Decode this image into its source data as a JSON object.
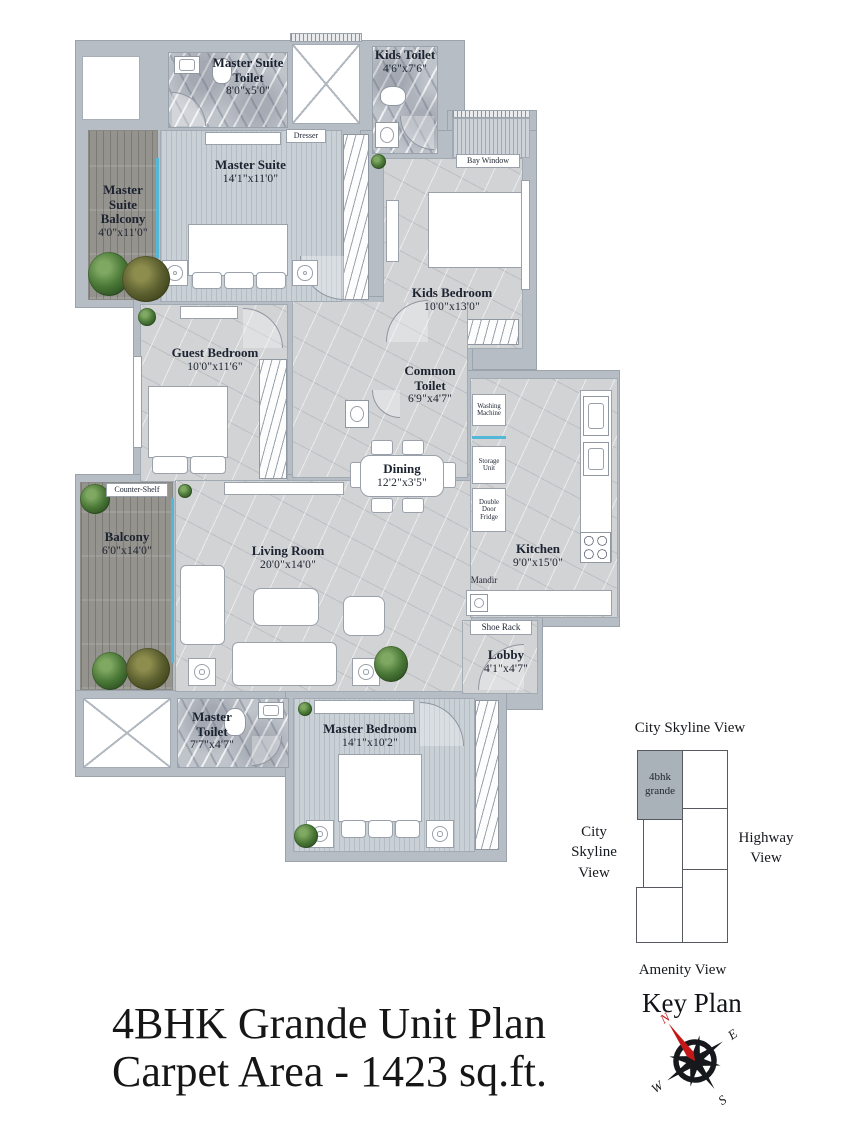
{
  "title": {
    "line1": "4BHK Grande Unit Plan",
    "line2": "Carpet Area - 1423 sq.ft."
  },
  "rooms": {
    "master_suite_toilet": {
      "name": "Master Suite Toilet",
      "dims": "8'0\"x5'0\""
    },
    "kids_toilet": {
      "name": "Kids Toilet",
      "dims": "4'6\"x7'6\""
    },
    "master_suite": {
      "name": "Master Suite",
      "dims": "14'1\"x11'0\""
    },
    "master_suite_balcony": {
      "name": "Master Suite Balcony",
      "dims": "4'0\"x11'0\""
    },
    "kids_bedroom": {
      "name": "Kids Bedroom",
      "dims": "10'0\"x13'0\""
    },
    "guest_bedroom": {
      "name": "Guest Bedroom",
      "dims": "10'0\"x11'6\""
    },
    "common_toilet": {
      "name": "Common Toilet",
      "dims": "6'9\"x4'7\""
    },
    "dining": {
      "name": "Dining",
      "dims": "12'2\"x3'5\""
    },
    "balcony": {
      "name": "Balcony",
      "dims": "6'0\"x14'0\""
    },
    "living_room": {
      "name": "Living Room",
      "dims": "20'0\"x14'0\""
    },
    "kitchen": {
      "name": "Kitchen",
      "dims": "9'0\"x15'0\""
    },
    "lobby": {
      "name": "Lobby",
      "dims": "4'1\"x4'7\""
    },
    "master_toilet": {
      "name": "Master Toilet",
      "dims": "7'7\"x4'7\""
    },
    "master_bedroom": {
      "name": "Master Bedroom",
      "dims": "14'1\"x10'2\""
    }
  },
  "fixtures": {
    "dresser": "Dresser",
    "bay_window": "Bay Window",
    "counter_shelf": "Counter-Shelf",
    "washing_machine": "Washing Machine",
    "storage_unit": "Storage Unit",
    "double_door_fridge": "Double Door Fridge",
    "mandir": "Mandir",
    "shoe_rack": "Shoe Rack"
  },
  "key_plan": {
    "title": "Key Plan",
    "top_label": "City Skyline View",
    "left_label": "City Skyline View",
    "right_label": "Highway View",
    "bottom_label": "Amenity View",
    "unit_label": "4bhk grande"
  },
  "compass": {
    "n": "N",
    "e": "E",
    "s": "S",
    "w": "W"
  },
  "colors": {
    "wall": "#b6bdc5",
    "window_accent": "#53b7d8",
    "keyplan_unit_fill": "#a9b1b9",
    "compass_north": "#c41818",
    "text": "#1c2330"
  }
}
